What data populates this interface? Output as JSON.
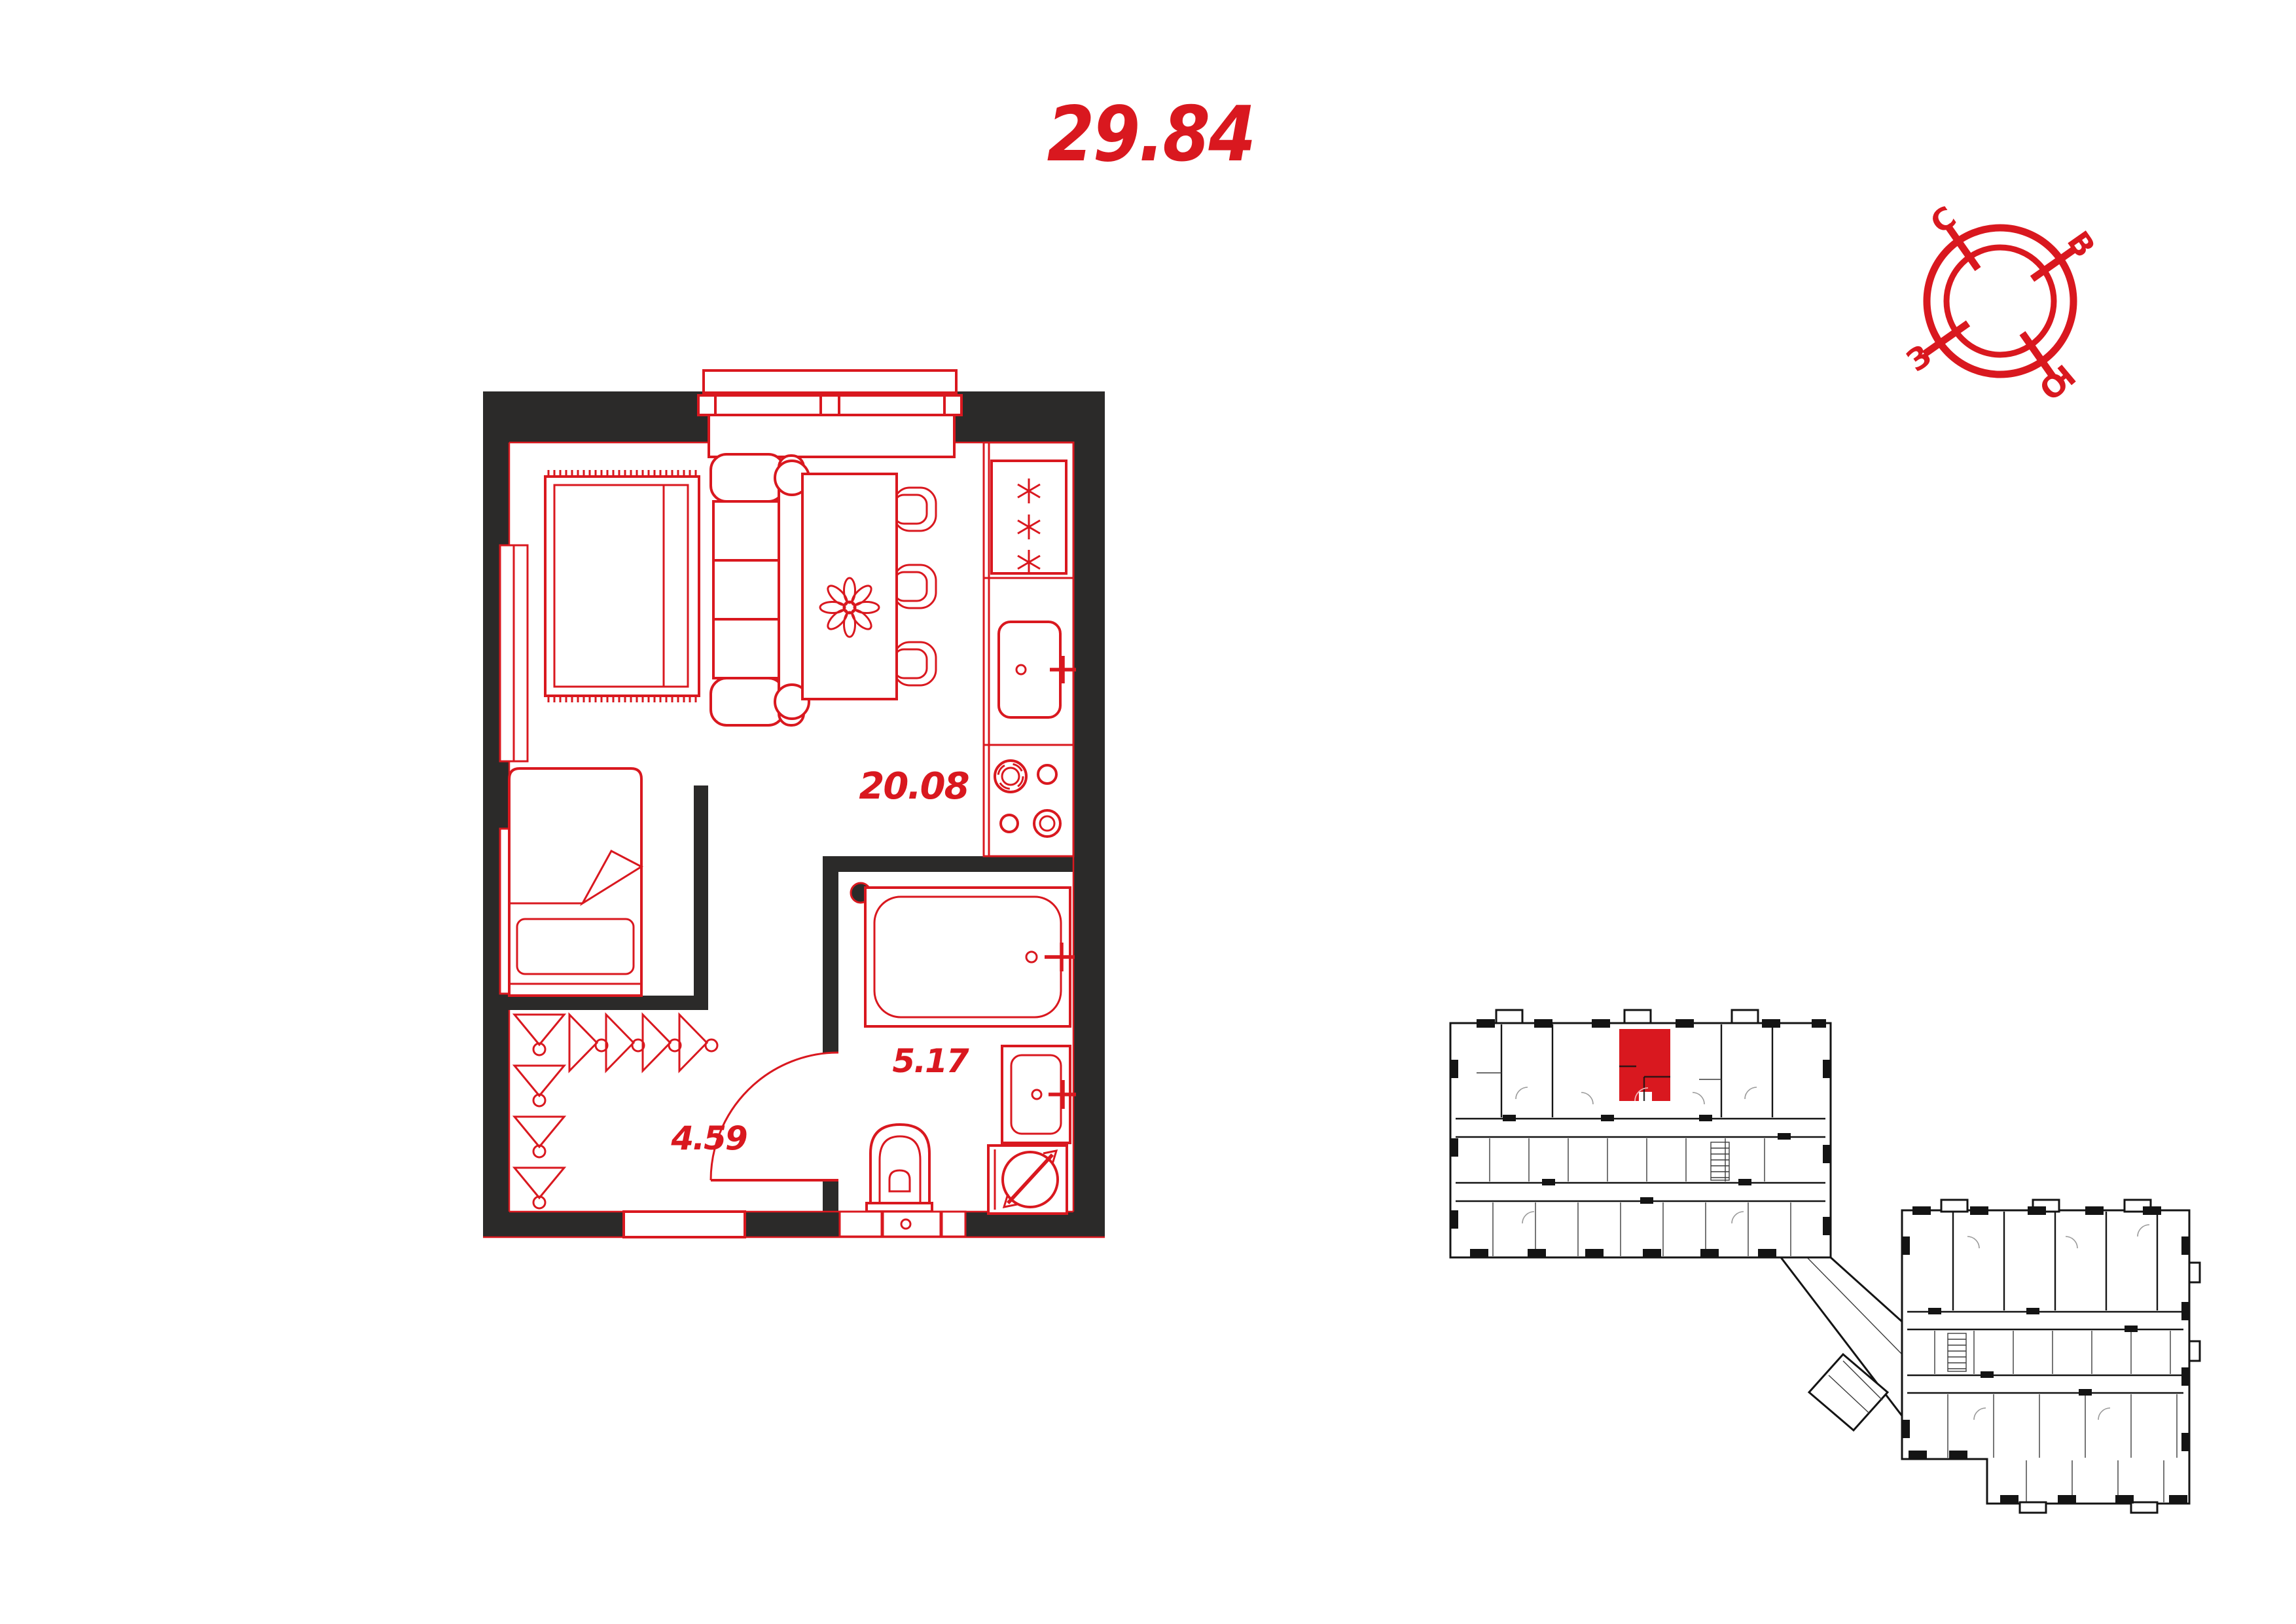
{
  "document": {
    "kind": "apartment-floor-plan"
  },
  "title": {
    "total_area": "29.84"
  },
  "floor_plan": {
    "rooms": [
      {
        "id": "living-kitchen",
        "area_label": "20.08"
      },
      {
        "id": "bathroom",
        "area_label": "5.17"
      },
      {
        "id": "hallway",
        "area_label": "4.59"
      }
    ],
    "icons": [
      "window-icon",
      "fridge-icon",
      "kitchen-sink-icon",
      "stove-icon",
      "double-bed-icon",
      "sofa-icon",
      "dining-table-icon",
      "flower-icon",
      "chair-icon",
      "single-bed-icon",
      "coat-hooks-icon",
      "bathtub-icon",
      "washbasin-icon",
      "washing-machine-icon",
      "toilet-icon",
      "door-arc-icon",
      "entry-opening"
    ]
  },
  "compass": {
    "labels": {
      "north": "С",
      "east": "В",
      "west": "З",
      "south": "Ю"
    }
  },
  "key_plan": {
    "highlighted_unit": "selected-apartment"
  },
  "colors": {
    "accent_red": "#d9181f",
    "wall_dark": "#2b2a29",
    "key_plan_line": "#141414",
    "background": "#ffffff"
  }
}
